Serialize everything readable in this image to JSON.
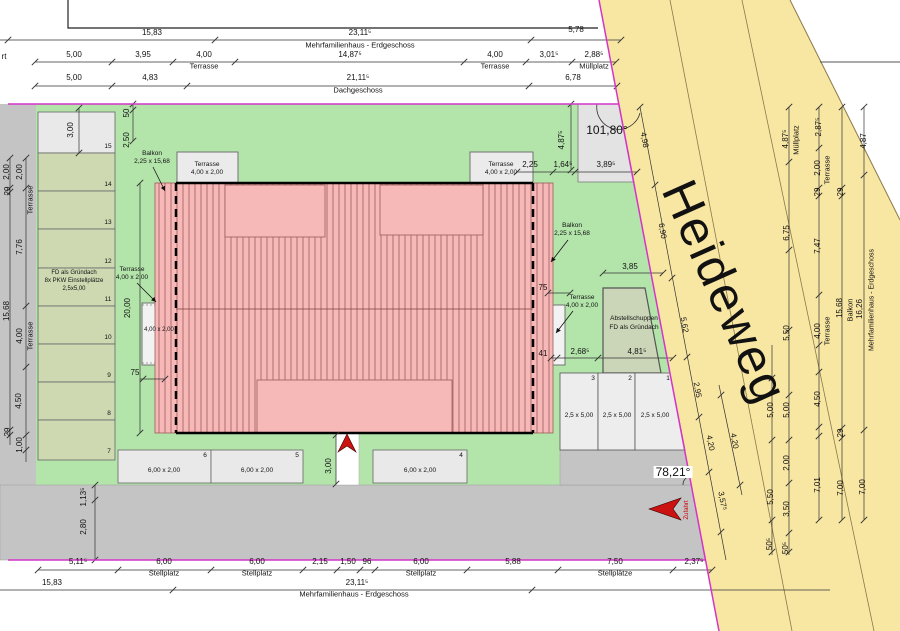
{
  "document": {
    "kind_label": "",
    "street": {
      "name": "Heideweg"
    }
  },
  "colors": {
    "lawn": "#b3e5ab",
    "street": "#f8e6a3",
    "roof_pink": "#f7b9b7",
    "boundary_magenta": "#d435c8",
    "gray_paving": "#c4c4c4",
    "parking_green": "#ced9b2",
    "terrace_gray": "#ebebeb",
    "arrow_red": "#cc1111"
  },
  "labels": {
    "top_dims": [
      {
        "text": "15,83",
        "x": 152,
        "y": 33
      },
      {
        "text": "23,11⁵",
        "x": 360,
        "y": 33
      },
      {
        "text": "Mehrfamilienhaus - Erdgeschoss",
        "x": 360,
        "y": 45,
        "size": 7.5
      },
      {
        "text": "5,78",
        "x": 576,
        "y": 30
      },
      {
        "text": "rt",
        "x": 4,
        "y": 57
      },
      {
        "text": "5,00",
        "x": 74,
        "y": 55
      },
      {
        "text": "3,95",
        "x": 143,
        "y": 55
      },
      {
        "text": "4,00",
        "x": 204,
        "y": 55
      },
      {
        "text": "Terrasse",
        "x": 204,
        "y": 66,
        "size": 7.5
      },
      {
        "text": "14,87⁵",
        "x": 350,
        "y": 55
      },
      {
        "text": "4,00",
        "x": 495,
        "y": 55
      },
      {
        "text": "Terrasse",
        "x": 495,
        "y": 66,
        "size": 7.5
      },
      {
        "text": "3,01⁵",
        "x": 549,
        "y": 55
      },
      {
        "text": "2,88⁵",
        "x": 594,
        "y": 55
      },
      {
        "text": "Müllplatz",
        "x": 594,
        "y": 66,
        "size": 7.5
      },
      {
        "text": "5,00",
        "x": 74,
        "y": 78
      },
      {
        "text": "4,83",
        "x": 150,
        "y": 78
      },
      {
        "text": "21,11⁵",
        "x": 358,
        "y": 78
      },
      {
        "text": "Dachgeschoss",
        "x": 358,
        "y": 90,
        "size": 7.5
      },
      {
        "text": "6,78",
        "x": 573,
        "y": 78
      }
    ],
    "bottom_dims": [
      {
        "text": "5,11⁵",
        "x": 78,
        "y": 562
      },
      {
        "text": "6,00",
        "x": 164,
        "y": 562
      },
      {
        "text": "Stellplatz",
        "x": 164,
        "y": 573,
        "size": 7.5
      },
      {
        "text": "6,00",
        "x": 257,
        "y": 562
      },
      {
        "text": "Stellplatz",
        "x": 257,
        "y": 573,
        "size": 7.5
      },
      {
        "text": "2,15",
        "x": 320,
        "y": 562
      },
      {
        "text": "1,50",
        "x": 348,
        "y": 562
      },
      {
        "text": "96",
        "x": 367,
        "y": 562
      },
      {
        "text": "6,00",
        "x": 421,
        "y": 562
      },
      {
        "text": "Stellplatz",
        "x": 421,
        "y": 573,
        "size": 7.5
      },
      {
        "text": "5,88",
        "x": 513,
        "y": 562
      },
      {
        "text": "7,50",
        "x": 615,
        "y": 562
      },
      {
        "text": "Stellplätze",
        "x": 615,
        "y": 573,
        "size": 7.5
      },
      {
        "text": "2,37⁵",
        "x": 694,
        "y": 562
      },
      {
        "text": "15,83",
        "x": 52,
        "y": 583
      },
      {
        "text": "23,11⁵",
        "x": 357,
        "y": 583
      },
      {
        "text": "Mehrfamilienhaus - Erdgeschoss",
        "x": 354,
        "y": 594,
        "size": 7.5
      },
      {
        "text": "1,13⁵",
        "x": 84,
        "y": 497,
        "rot": -90
      },
      {
        "text": "2,80",
        "x": 84,
        "y": 527,
        "rot": -90
      }
    ],
    "left_dims": [
      {
        "text": "2,00",
        "x": 7,
        "y": 172,
        "rot": -90
      },
      {
        "text": "29",
        "x": 8,
        "y": 191,
        "rot": -90
      },
      {
        "text": "15,68",
        "x": 7,
        "y": 311,
        "rot": -90
      },
      {
        "text": "29",
        "x": 8,
        "y": 432,
        "rot": -90
      },
      {
        "text": "2,00",
        "x": 20,
        "y": 172,
        "rot": -90
      },
      {
        "text": "Terrasse",
        "x": 30,
        "y": 200,
        "rot": -90,
        "size": 7.5
      },
      {
        "text": "7,76",
        "x": 20,
        "y": 247,
        "rot": -90
      },
      {
        "text": "4,00",
        "x": 20,
        "y": 336,
        "rot": -90
      },
      {
        "text": "Terrasse",
        "x": 30,
        "y": 336,
        "rot": -90,
        "size": 7.5
      },
      {
        "text": "4,50",
        "x": 19,
        "y": 401,
        "rot": -90
      },
      {
        "text": "1,00",
        "x": 20,
        "y": 445,
        "rot": -90
      },
      {
        "text": "50",
        "x": 127,
        "y": 113,
        "rot": -90
      },
      {
        "text": "2,50",
        "x": 127,
        "y": 140,
        "rot": -90
      },
      {
        "text": "3,00",
        "x": 71,
        "y": 130,
        "rot": -90
      },
      {
        "text": "20,00",
        "x": 128,
        "y": 308,
        "rot": -90
      },
      {
        "text": "75",
        "x": 135,
        "y": 373
      }
    ],
    "site_labels": [
      {
        "text": "Balkon",
        "x": 152,
        "y": 154,
        "size": 6.5
      },
      {
        "text": "2,25 x 15,68",
        "x": 152,
        "y": 162,
        "size": 6.5
      },
      {
        "text": "Terrasse",
        "x": 207,
        "y": 165,
        "size": 6.5
      },
      {
        "text": "4,00 x 2,00",
        "x": 207,
        "y": 173,
        "size": 6.5
      },
      {
        "text": "Terrasse",
        "x": 501,
        "y": 165,
        "size": 6.5
      },
      {
        "text": "4,00 x 2,00",
        "x": 501,
        "y": 173,
        "size": 6.5
      },
      {
        "text": "Terrasse",
        "x": 132,
        "y": 270,
        "size": 6.5
      },
      {
        "text": "4,00 x 2,00",
        "x": 132,
        "y": 278,
        "size": 6.5
      },
      {
        "text": "4,00 x 2,00",
        "x": 159,
        "y": 330,
        "size": 6
      },
      {
        "text": "Balkon",
        "x": 572,
        "y": 226,
        "size": 6.5
      },
      {
        "text": "2,25 x 15,68",
        "x": 572,
        "y": 234,
        "size": 6.5
      },
      {
        "text": "Terrasse",
        "x": 582,
        "y": 298,
        "size": 6.5
      },
      {
        "text": "4,00 x 2,00",
        "x": 582,
        "y": 306,
        "size": 6.5
      },
      {
        "text": "FD als Gründach",
        "x": 74,
        "y": 273,
        "size": 6
      },
      {
        "text": "8x PKW Einstellplätze",
        "x": 74,
        "y": 281,
        "size": 6
      },
      {
        "text": "2,5x5,00",
        "x": 74,
        "y": 289,
        "size": 6
      },
      {
        "text": "Abstellschuppen",
        "x": 634,
        "y": 319,
        "size": 6.5
      },
      {
        "text": "FD als Gründach",
        "x": 634,
        "y": 328,
        "size": 6.5
      },
      {
        "text": "101,80°",
        "x": 607,
        "y": 130,
        "size": 12
      },
      {
        "text": "78,21°",
        "x": 673,
        "y": 472,
        "size": 12,
        "bg": "#ffffff"
      },
      {
        "text": "Zufahrt",
        "x": 687,
        "y": 510,
        "rot": -90,
        "size": 6,
        "color": "#cc0000"
      }
    ],
    "parking_labels": [
      {
        "text": "15",
        "x": 108,
        "y": 147,
        "size": 6.5
      },
      {
        "text": "14",
        "x": 108,
        "y": 185,
        "size": 6.5
      },
      {
        "text": "13",
        "x": 108,
        "y": 223,
        "size": 6.5
      },
      {
        "text": "12",
        "x": 108,
        "y": 262,
        "size": 6.5
      },
      {
        "text": "11",
        "x": 108,
        "y": 300,
        "size": 6.5
      },
      {
        "text": "10",
        "x": 108,
        "y": 338,
        "size": 6.5
      },
      {
        "text": "9",
        "x": 109,
        "y": 376,
        "size": 6.5
      },
      {
        "text": "8",
        "x": 109,
        "y": 414,
        "size": 6.5
      },
      {
        "text": "7",
        "x": 109,
        "y": 452,
        "size": 6.5
      },
      {
        "text": "6",
        "x": 205,
        "y": 456,
        "size": 6.5
      },
      {
        "text": "5",
        "x": 297,
        "y": 456,
        "size": 6.5
      },
      {
        "text": "4",
        "x": 461,
        "y": 456,
        "size": 6.5
      },
      {
        "text": "6,00 x 2,00",
        "x": 164,
        "y": 471,
        "size": 6.5
      },
      {
        "text": "6,00 x 2,00",
        "x": 257,
        "y": 471,
        "size": 6.5
      },
      {
        "text": "6,00 x 2,00",
        "x": 420,
        "y": 471,
        "size": 6.5
      },
      {
        "text": "3,00",
        "x": 329,
        "y": 466,
        "rot": -90
      },
      {
        "text": "3",
        "x": 593,
        "y": 379,
        "size": 6.5
      },
      {
        "text": "2",
        "x": 630,
        "y": 379,
        "size": 6.5
      },
      {
        "text": "1",
        "x": 668,
        "y": 379,
        "size": 6.5
      },
      {
        "text": "2,5 x 5,00",
        "x": 579,
        "y": 416,
        "size": 6.5
      },
      {
        "text": "2,5 x 5,00",
        "x": 617,
        "y": 416,
        "size": 6.5
      },
      {
        "text": "2,5 x 5,00",
        "x": 655,
        "y": 416,
        "size": 6.5
      }
    ],
    "right_dims": [
      {
        "text": "4,87⁵",
        "x": 562,
        "y": 140,
        "rot": -90
      },
      {
        "text": "2,25",
        "x": 530,
        "y": 165
      },
      {
        "text": "1,64⁵",
        "x": 563,
        "y": 165
      },
      {
        "text": "3,89⁵",
        "x": 606,
        "y": 165
      },
      {
        "text": "75",
        "x": 543,
        "y": 288
      },
      {
        "text": "41",
        "x": 543,
        "y": 354
      },
      {
        "text": "2,68⁵",
        "x": 580,
        "y": 352
      },
      {
        "text": "4,81⁵",
        "x": 637,
        "y": 352
      },
      {
        "text": "3,85",
        "x": 630,
        "y": 267
      }
    ],
    "street_dims": [
      {
        "text": "4,98",
        "x": 644,
        "y": 140,
        "rot": 80
      },
      {
        "text": "6,90",
        "x": 662,
        "y": 231,
        "rot": 80
      },
      {
        "text": "5,62",
        "x": 684,
        "y": 325,
        "rot": 80
      },
      {
        "text": "2,95",
        "x": 697,
        "y": 390,
        "rot": 80
      },
      {
        "text": "4,20",
        "x": 710,
        "y": 443,
        "rot": 80
      },
      {
        "text": "3,57⁵",
        "x": 722,
        "y": 501,
        "rot": 80
      },
      {
        "text": "4,20",
        "x": 734,
        "y": 441,
        "rot": 80
      },
      {
        "text": "Heideweg",
        "x": 725,
        "y": 292,
        "rot": 66,
        "size": 50,
        "spacing": 2,
        "name": "street-name-label"
      }
    ],
    "right_chains": [
      {
        "text": "4,87⁵",
        "x": 786,
        "y": 139,
        "rot": -90
      },
      {
        "text": "Müllplatz",
        "x": 796,
        "y": 140,
        "rot": -90,
        "size": 7.5
      },
      {
        "text": "6,75",
        "x": 787,
        "y": 233,
        "rot": -90
      },
      {
        "text": "5,50",
        "x": 787,
        "y": 333,
        "rot": -90
      },
      {
        "text": "5,00",
        "x": 787,
        "y": 410,
        "rot": -90
      },
      {
        "text": "2,00",
        "x": 787,
        "y": 463,
        "rot": -90
      },
      {
        "text": "3,50",
        "x": 787,
        "y": 509,
        "rot": -90
      },
      {
        "text": "50⁵",
        "x": 786,
        "y": 548,
        "rot": -90
      },
      {
        "text": "5,00",
        "x": 771,
        "y": 410,
        "rot": -90
      },
      {
        "text": "5,50",
        "x": 771,
        "y": 497,
        "rot": -90
      },
      {
        "text": "50⁵",
        "x": 770,
        "y": 544,
        "rot": -90
      },
      {
        "text": "2,87⁵",
        "x": 819,
        "y": 127,
        "rot": -90
      },
      {
        "text": "2,00",
        "x": 818,
        "y": 168,
        "rot": -90
      },
      {
        "text": "Terrasse",
        "x": 827,
        "y": 170,
        "rot": -90,
        "size": 7.5
      },
      {
        "text": "29",
        "x": 818,
        "y": 192,
        "rot": -90
      },
      {
        "text": "7,47",
        "x": 818,
        "y": 246,
        "rot": -90
      },
      {
        "text": "4,00",
        "x": 818,
        "y": 331,
        "rot": -90
      },
      {
        "text": "Terrasse",
        "x": 827,
        "y": 331,
        "rot": -90,
        "size": 7.5
      },
      {
        "text": "4,50",
        "x": 818,
        "y": 399,
        "rot": -90
      },
      {
        "text": "7,01",
        "x": 818,
        "y": 485,
        "rot": -90
      },
      {
        "text": "29",
        "x": 841,
        "y": 192,
        "rot": -90
      },
      {
        "text": "15,68",
        "x": 840,
        "y": 308,
        "rot": -90
      },
      {
        "text": "Balkon",
        "x": 850,
        "y": 310,
        "rot": -90,
        "size": 7.5
      },
      {
        "text": "29",
        "x": 841,
        "y": 433,
        "rot": -90
      },
      {
        "text": "7,00",
        "x": 841,
        "y": 488,
        "rot": -90
      },
      {
        "text": "4,87",
        "x": 864,
        "y": 141,
        "rot": -90
      },
      {
        "text": "16,26",
        "x": 860,
        "y": 309,
        "rot": -90
      },
      {
        "text": "Mehrfamilienhaus - Erdgeschoss",
        "x": 872,
        "y": 300,
        "rot": -90,
        "size": 7
      },
      {
        "text": "7,00",
        "x": 863,
        "y": 487,
        "rot": -90
      }
    ]
  }
}
